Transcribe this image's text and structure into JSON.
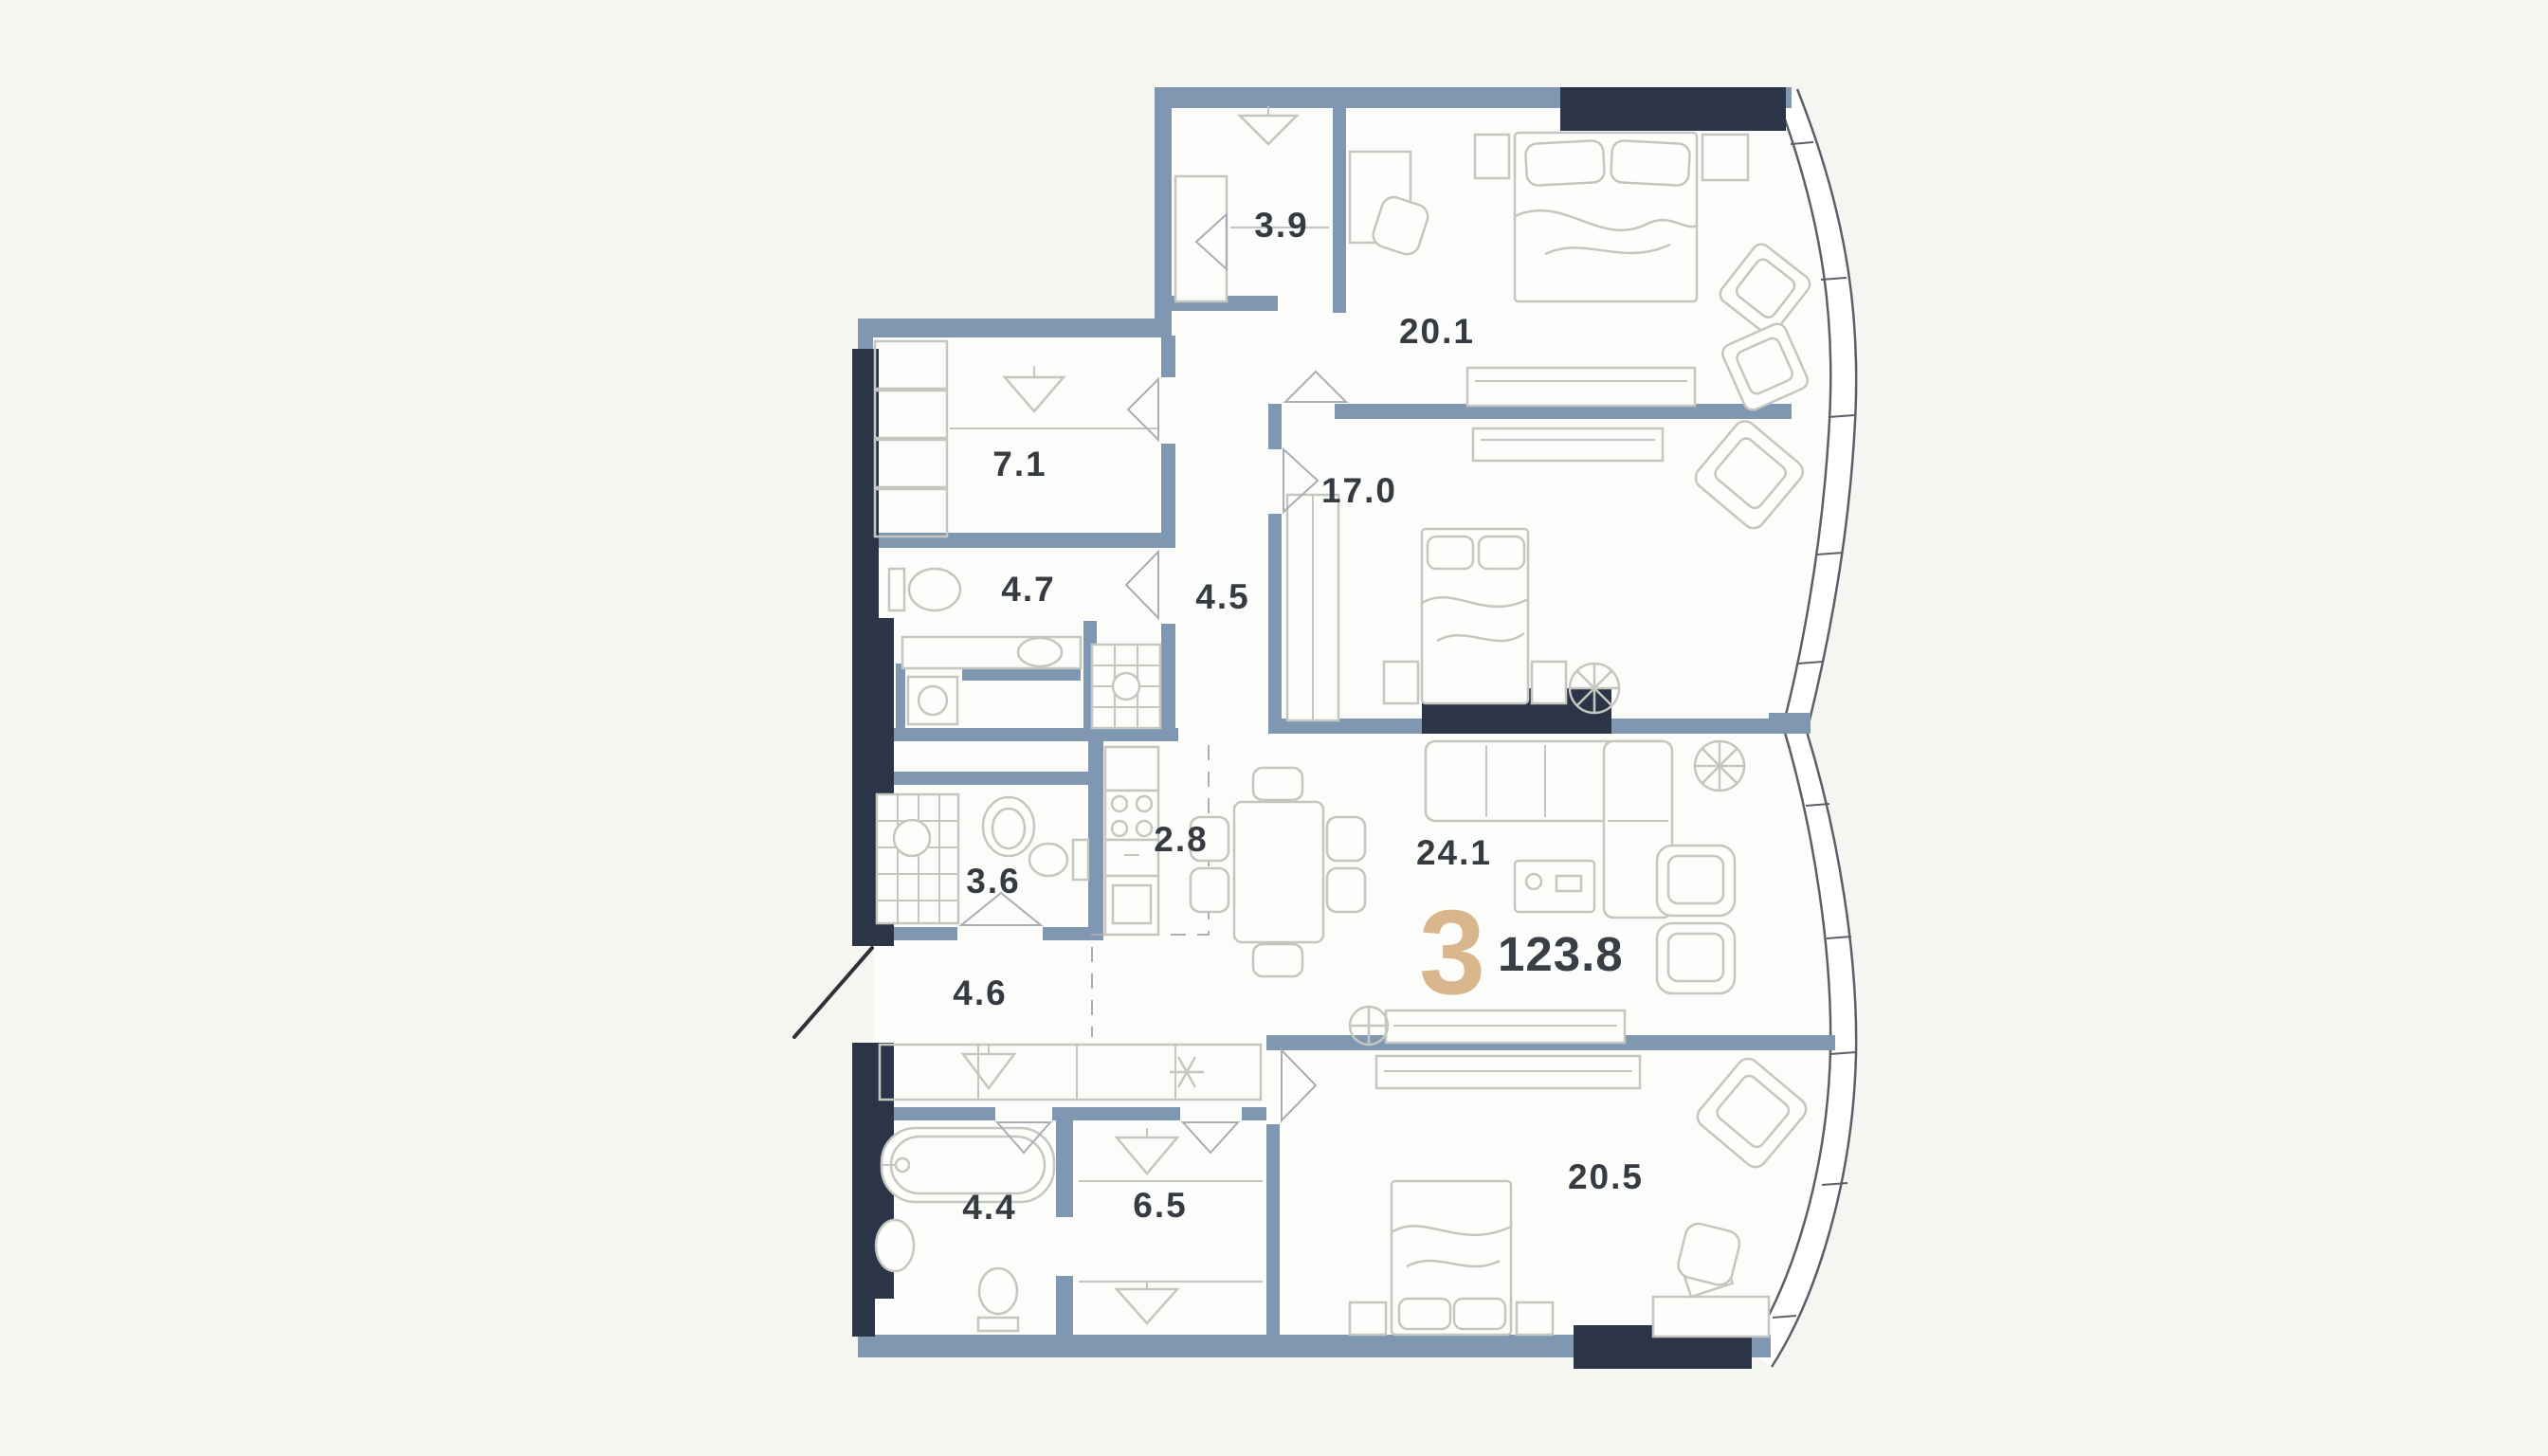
{
  "unit": {
    "rooms_count": "3",
    "total_area": "123.8"
  },
  "rooms": [
    {
      "id": "wardrobe-3-9",
      "name": "wardrobe",
      "area": "3.9"
    },
    {
      "id": "bedroom-20-1",
      "name": "bedroom",
      "area": "20.1"
    },
    {
      "id": "closet-7-1",
      "name": "walk-in closet",
      "area": "7.1"
    },
    {
      "id": "bathroom-4-7",
      "name": "bathroom",
      "area": "4.7"
    },
    {
      "id": "hallway-4-5",
      "name": "hallway",
      "area": "4.5"
    },
    {
      "id": "bedroom-17-0",
      "name": "bedroom",
      "area": "17.0"
    },
    {
      "id": "kitchen-2-8",
      "name": "kitchen",
      "area": "2.8"
    },
    {
      "id": "bathroom-3-6",
      "name": "bathroom",
      "area": "3.6"
    },
    {
      "id": "living-24-1",
      "name": "living-dining",
      "area": "24.1"
    },
    {
      "id": "hallway-4-6",
      "name": "entrance hall",
      "area": "4.6"
    },
    {
      "id": "bathroom-4-4",
      "name": "bathroom",
      "area": "4.4"
    },
    {
      "id": "wardrobe-6-5",
      "name": "wardrobe",
      "area": "6.5"
    },
    {
      "id": "bedroom-20-5",
      "name": "bedroom",
      "area": "20.5"
    }
  ],
  "icons": {
    "hanger": "wardrobe-hanger-triangle",
    "snowflake": "air-conditioner",
    "plant": "potted-plant"
  },
  "colors": {
    "wall": "#8097b2",
    "wall_dark": "#2b3547",
    "accent": "#d9b68c",
    "label": "#363b42",
    "background": "#f5f5f2",
    "paper": "#fcfcfa"
  }
}
